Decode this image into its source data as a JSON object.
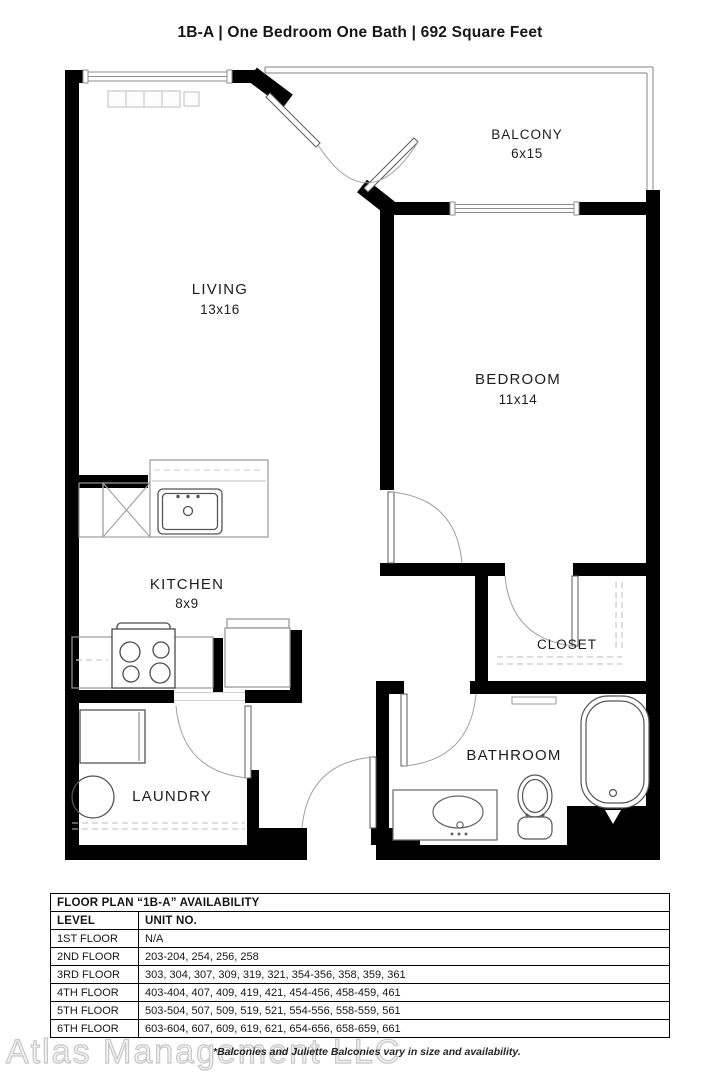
{
  "header": {
    "title": "1B-A | One Bedroom One Bath | 692 Square Feet"
  },
  "plan": {
    "rooms": [
      {
        "name": "BALCONY",
        "dims": "6x15"
      },
      {
        "name": "LIVING",
        "dims": "13x16"
      },
      {
        "name": "BEDROOM",
        "dims": "11x14"
      },
      {
        "name": "KITCHEN",
        "dims": "8x9"
      },
      {
        "name": "CLOSET",
        "dims": ""
      },
      {
        "name": "LAUNDRY",
        "dims": ""
      },
      {
        "name": "BATHROOM",
        "dims": ""
      }
    ],
    "fixtures": [
      "kitchen-sink",
      "dishwasher",
      "stove",
      "refrigerator",
      "washer",
      "dryer",
      "vanity-sink",
      "toilet",
      "bathtub",
      "baseboard-heater"
    ],
    "colors": {
      "wall": "#000000",
      "fixture_line": "#555555",
      "light_line": "#aaaaaa",
      "dash_line": "#bbbbbb"
    }
  },
  "table": {
    "title": "FLOOR PLAN “1B-A” AVAILABILITY",
    "columns": [
      "LEVEL",
      "UNIT NO."
    ],
    "rows": [
      [
        "1ST FLOOR",
        "N/A"
      ],
      [
        "2ND FLOOR",
        "203-204, 254, 256, 258"
      ],
      [
        "3RD FLOOR",
        "303, 304, 307, 309, 319, 321, 354-356, 358, 359, 361"
      ],
      [
        "4TH FLOOR",
        "403-404, 407, 409, 419, 421, 454-456, 458-459, 461"
      ],
      [
        "5TH FLOOR",
        "503-504, 507, 509, 519, 521, 554-556, 558-559, 561"
      ],
      [
        "6TH FLOOR",
        "603-604, 607, 609, 619, 621, 654-656, 658-659, 661"
      ]
    ]
  },
  "footer": {
    "watermark": "Atlas Management LLC",
    "note": "*Balconies and Juliette Balconies vary in size and availability."
  }
}
